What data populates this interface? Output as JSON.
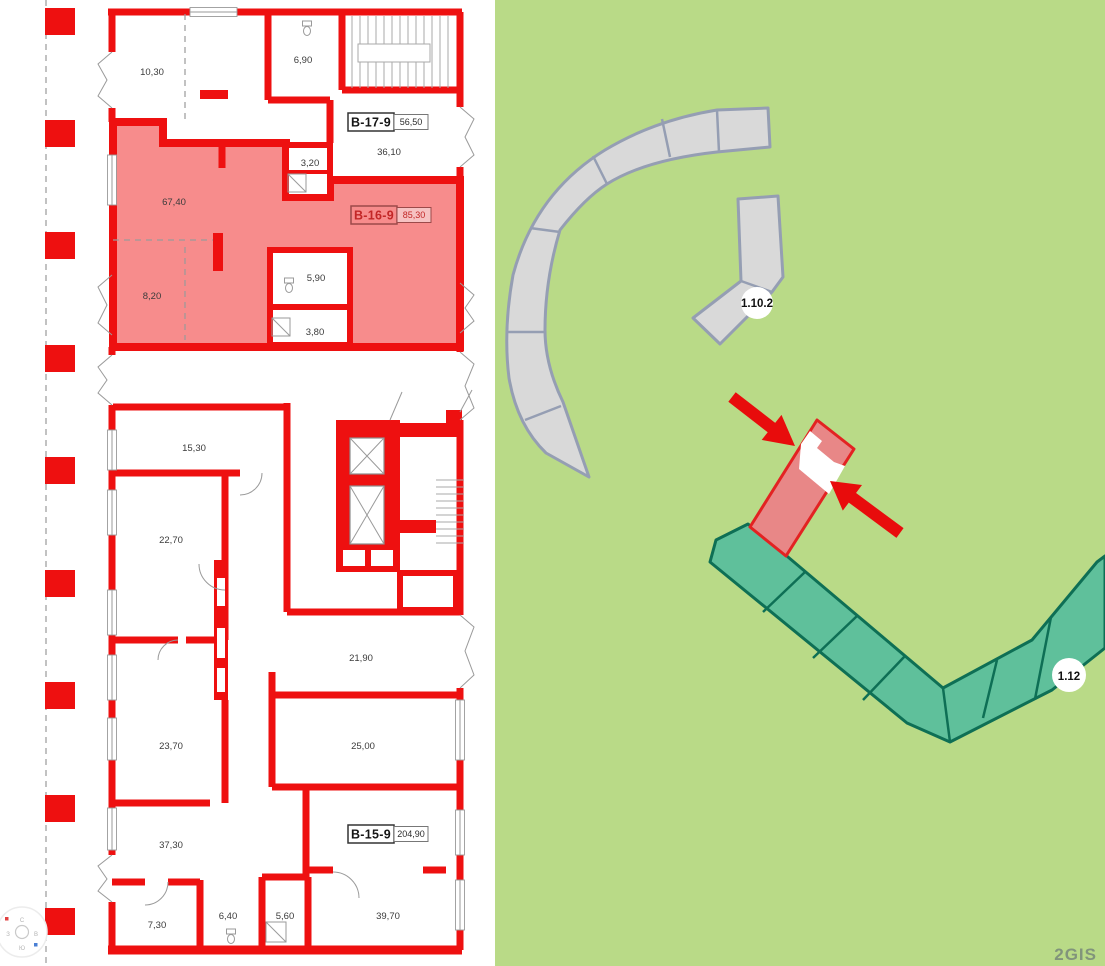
{
  "app": {
    "watermark": "2GIS"
  },
  "floor_plan": {
    "units": [
      {
        "id": "B-17-9",
        "area": "56,50"
      },
      {
        "id": "B-16-9",
        "area": "85,30"
      },
      {
        "id": "B-15-9",
        "area": "204,90"
      }
    ],
    "rooms": [
      {
        "area": "10,30"
      },
      {
        "area": "6,90"
      },
      {
        "area": "36,10"
      },
      {
        "area": "3,20"
      },
      {
        "area": "67,40"
      },
      {
        "area": "5,90"
      },
      {
        "area": "8,20"
      },
      {
        "area": "3,80"
      },
      {
        "area": "15,30"
      },
      {
        "area": "22,70"
      },
      {
        "area": "21,90"
      },
      {
        "area": "23,70"
      },
      {
        "area": "25,00"
      },
      {
        "area": "37,30"
      },
      {
        "area": "7,30"
      },
      {
        "area": "6,40"
      },
      {
        "area": "5,60"
      },
      {
        "area": "39,70"
      }
    ],
    "compass": {
      "north": "С",
      "east": "В",
      "south": "Ю",
      "west": "З"
    },
    "colors": {
      "wall": "#ee1010",
      "highlight_fill": "#f78c8c"
    }
  },
  "map": {
    "badges": [
      {
        "label": "1.10.2"
      },
      {
        "label": "1.12"
      }
    ],
    "colors": {
      "background": "#b9da87",
      "building_fill": "#d9d9d9",
      "building_stroke": "#959eb3",
      "residential_fill": "#5fc09b",
      "residential_stroke": "#0e6f55",
      "selected_fill": "#e88787",
      "selected_stroke": "#e32222",
      "arrow": "#e80c0c"
    }
  }
}
